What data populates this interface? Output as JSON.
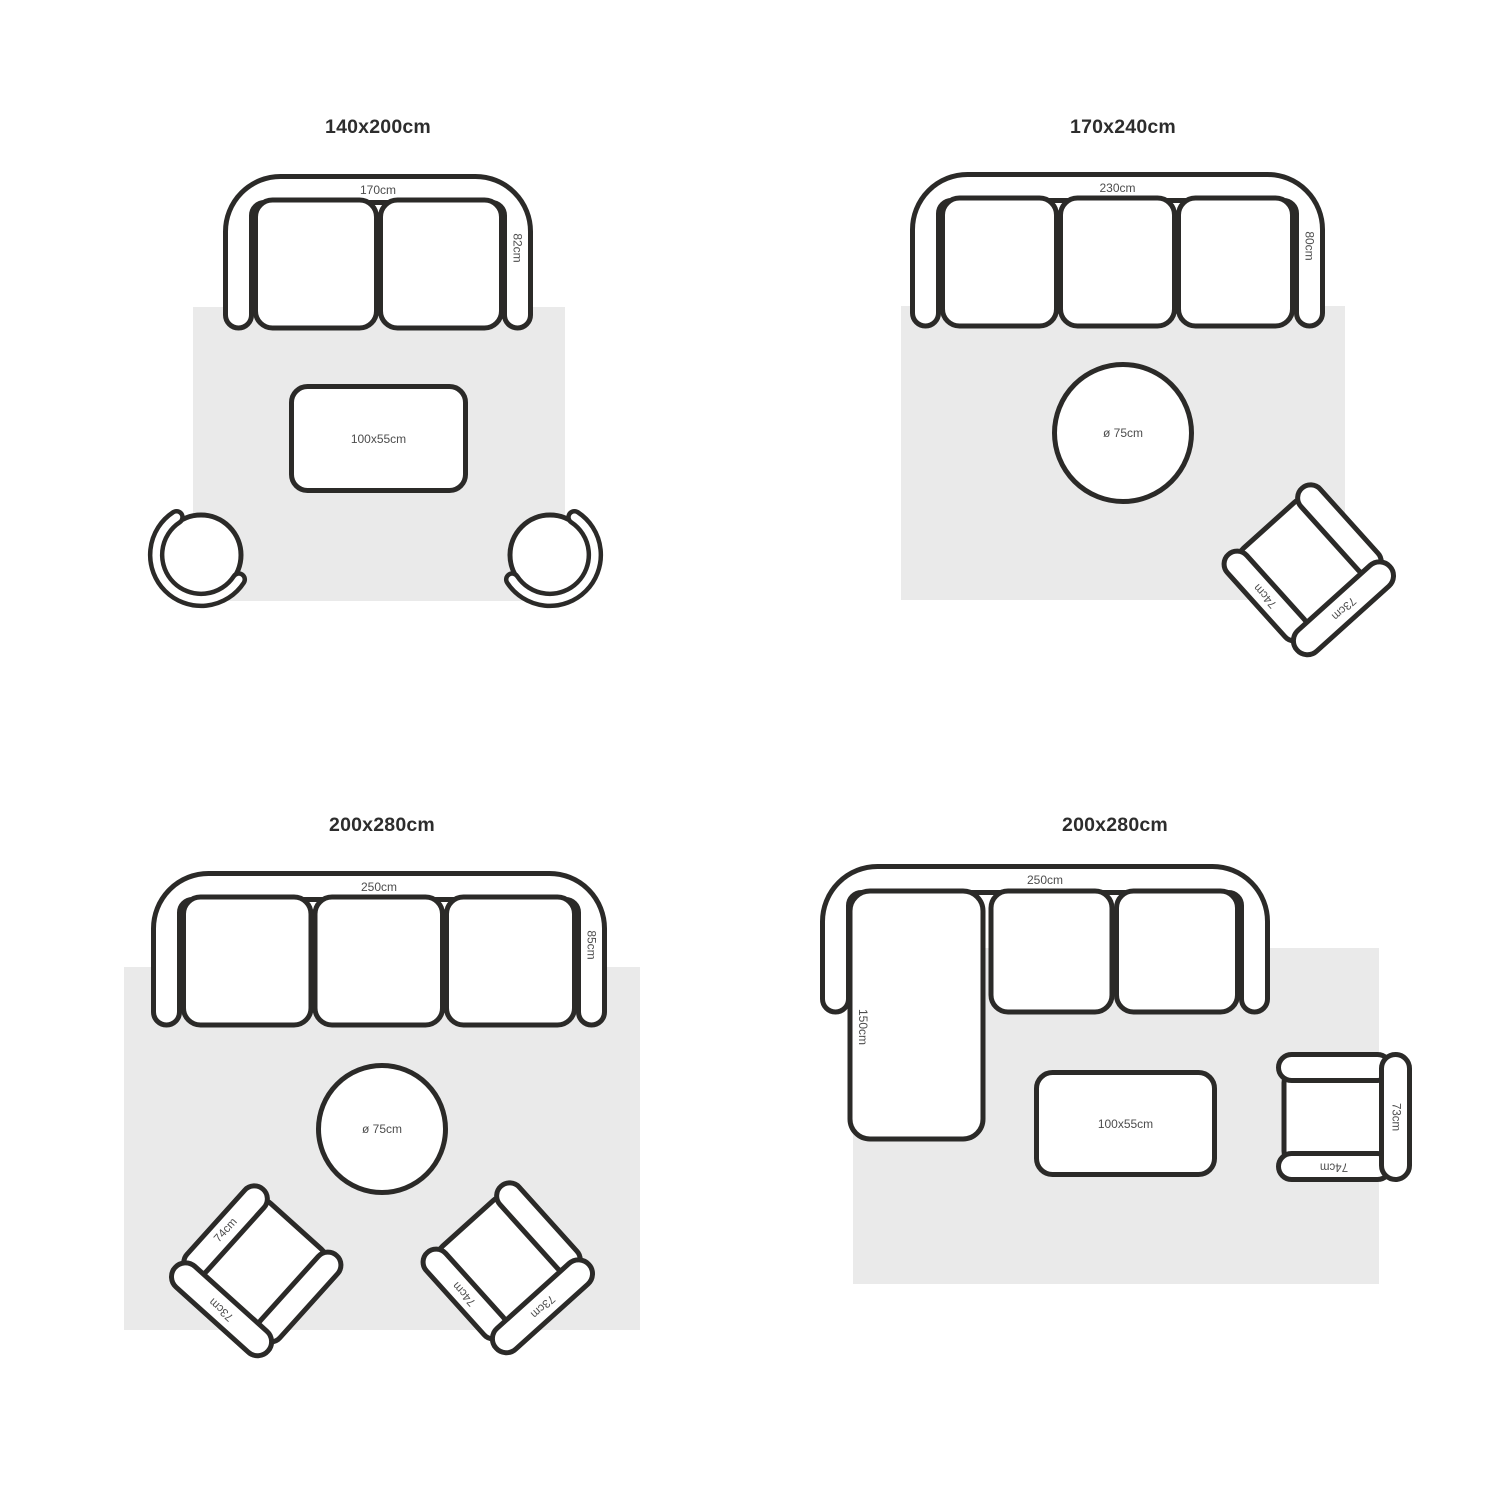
{
  "colors": {
    "background": "#ffffff",
    "outline": "#2b2a28",
    "rug_fill": "#eaeaea",
    "dimension_text": "#4d4d4d",
    "title_text": "#2d2d2d"
  },
  "panels": [
    {
      "title": "140x200cm",
      "sofa": {
        "seats": "2",
        "width_label": "170cm",
        "depth_label": "82cm"
      },
      "coffee_table": {
        "label": "100x55cm"
      }
    },
    {
      "title": "170x240cm",
      "sofa": {
        "seats": "3",
        "width_label": "230cm",
        "depth_label": "80cm"
      },
      "round_table": {
        "label": "ø 75cm"
      },
      "armchair": {
        "arm_label": "74cm",
        "back_label": "73cm"
      }
    },
    {
      "title": "200x280cm",
      "sofa": {
        "seats": "3",
        "width_label": "250cm",
        "depth_label": "85cm"
      },
      "round_table": {
        "label": "ø 75cm"
      },
      "armchair_left": {
        "arm_label": "74cm",
        "back_label": "73cm"
      },
      "armchair_right": {
        "arm_label": "74cm",
        "back_label": "73cm"
      }
    },
    {
      "title": "200x280cm",
      "sofa": {
        "seats": "2",
        "type": "sectional",
        "width_label": "250cm",
        "chaise_label": "150cm"
      },
      "coffee_table": {
        "label": "100x55cm"
      },
      "armchair": {
        "arm_label": "74cm",
        "back_label": "73cm"
      }
    }
  ]
}
